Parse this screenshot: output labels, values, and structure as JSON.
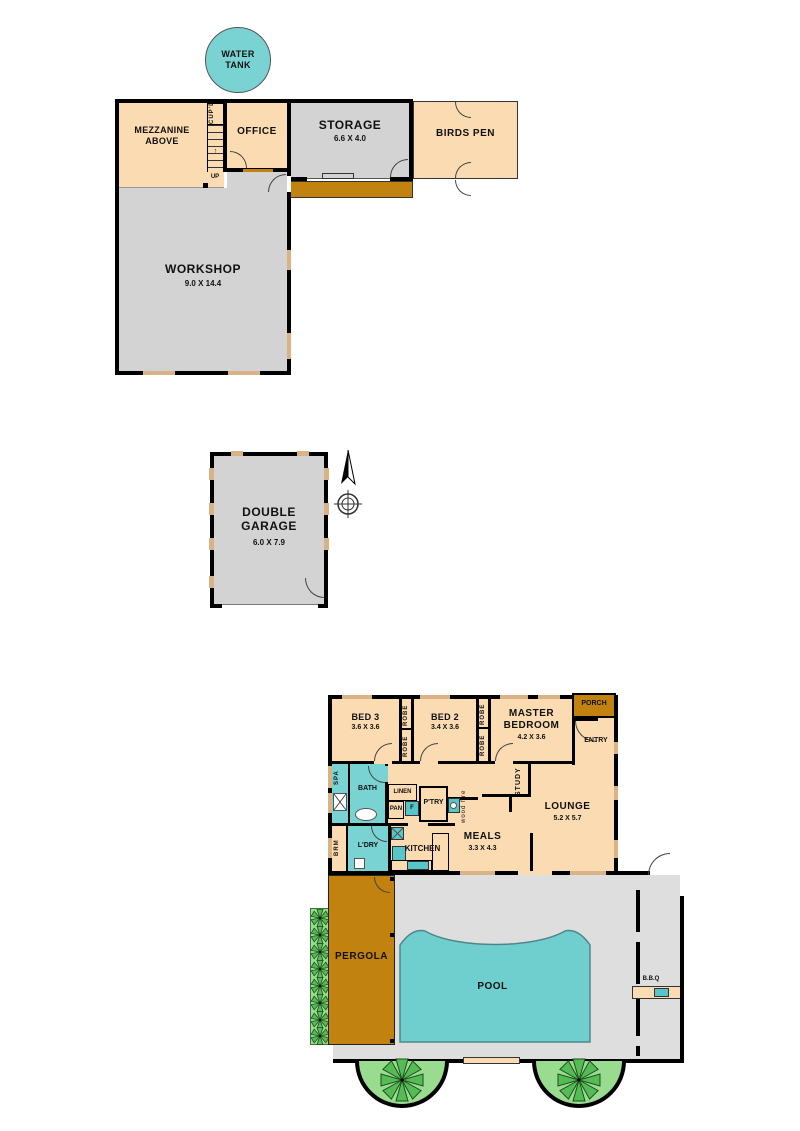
{
  "colors": {
    "peach": "#FBDCB2",
    "room-gray": "#D3D3D3",
    "yard-gray": "#DEDEDE",
    "teal": "#7AD3D3",
    "fixture-teal": "#56C6C8",
    "pool-teal": "#6FCFCF",
    "brown": "#C1820F",
    "window-tan": "#D9B386",
    "light-green": "#99DC90",
    "plant-green": "#55BB55",
    "wall-black": "#000000"
  },
  "site": {
    "water_tank_label": "WATER\nTANK",
    "mezzanine_label": "MEZZANINE\nABOVE",
    "cupd_label": "CUP'D",
    "up_label": "UP",
    "office_label": "OFFICE",
    "storage_label": "STORAGE",
    "storage_dims": "6.6 X 4.0",
    "birds_pen_label": "BIRDS PEN",
    "workshop_label": "WORKSHOP",
    "workshop_dims": "9.0 X 14.4",
    "garage_label": "DOUBLE\nGARAGE",
    "garage_dims": "6.0 X 7.9"
  },
  "house": {
    "bed3_label": "BED 3",
    "bed3_dims": "3.6 X 3.6",
    "robe_label": "ROBE",
    "bed2_label": "BED 2",
    "bed2_dims": "3.4 X 3.6",
    "master_label": "MASTER\nBEDROOM",
    "master_dims": "4.2 X 3.6",
    "porch_label": "PORCH",
    "entry_label": "ENTRY",
    "spa_label": "SPA",
    "bath_label": "BATH",
    "linen_label": "LINEN",
    "pan_label": "PAN",
    "ptry_label": "P'TRY",
    "fridge_label": "F",
    "wood_fire_label": "wood fire",
    "study_label": "STUDY",
    "lounge_label": "LOUNGE",
    "lounge_dims": "5.2 X 5.7",
    "meals_label": "MEALS",
    "meals_dims": "3.3 X 4.3",
    "brm_label": "BRM",
    "ldry_label": "L'DRY",
    "kitchen_label": "KITCHEN"
  },
  "outdoor": {
    "pergola_label": "PERGOLA",
    "pool_label": "POOL",
    "bbq_label": "B.B.Q"
  }
}
